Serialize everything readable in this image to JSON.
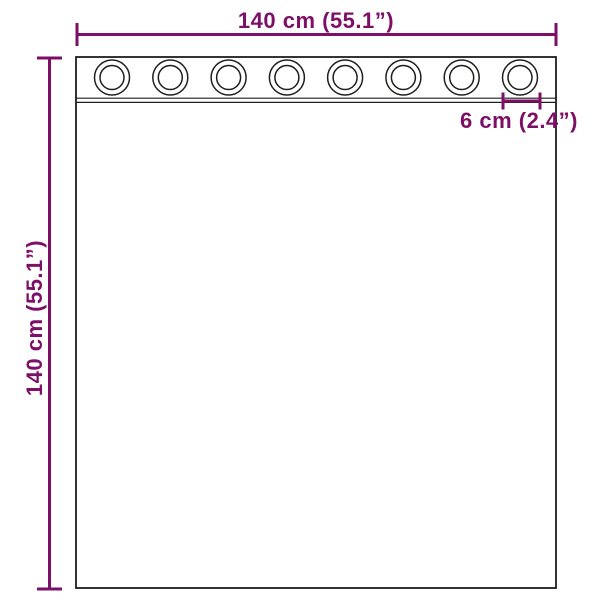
{
  "colors": {
    "dimension_accent": "#7D0F66",
    "outline": "#1e1e1c",
    "background": "#ffffff",
    "fabric_fill": "#ffffff"
  },
  "diagram": {
    "type": "curtain-dimension-diagram",
    "grommet_count": 8,
    "labels": {
      "width": "140 cm (55.1”)",
      "height": "140 cm (55.1”)",
      "grommet_diameter": "6 cm (2.4”)"
    }
  }
}
